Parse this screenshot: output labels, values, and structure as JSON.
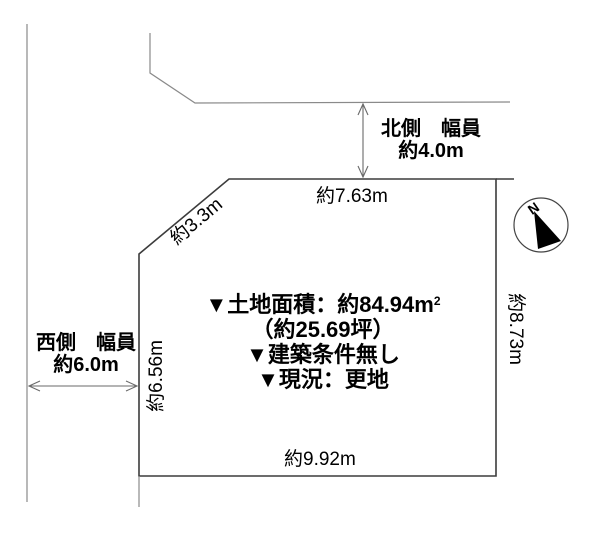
{
  "roads": {
    "north": {
      "side_label": "北側　幅員",
      "width_value": "約4.0m"
    },
    "west": {
      "side_label": "西側　幅員",
      "width_value": "約6.0m"
    }
  },
  "plot": {
    "dimensions": {
      "top": "約7.63m",
      "diagonal": "約3.3m",
      "left": "約6.56m",
      "right": "約8.73m",
      "bottom": "約9.92m"
    },
    "info": {
      "area": "▼土地面積：約84.94m",
      "area_superscript": "2",
      "tsubo": "（約25.69坪）",
      "building_condition": "▼建築条件無し",
      "current_status": "▼現況：更地"
    }
  },
  "compass": {
    "north_label": "N"
  },
  "colors": {
    "background": "#ffffff",
    "plot_outline": "#3c3c3c",
    "road_line": "#8a8a8a",
    "dimension_arrow": "#6a6a6a",
    "text": "#000000",
    "compass_needle": "#000000"
  }
}
